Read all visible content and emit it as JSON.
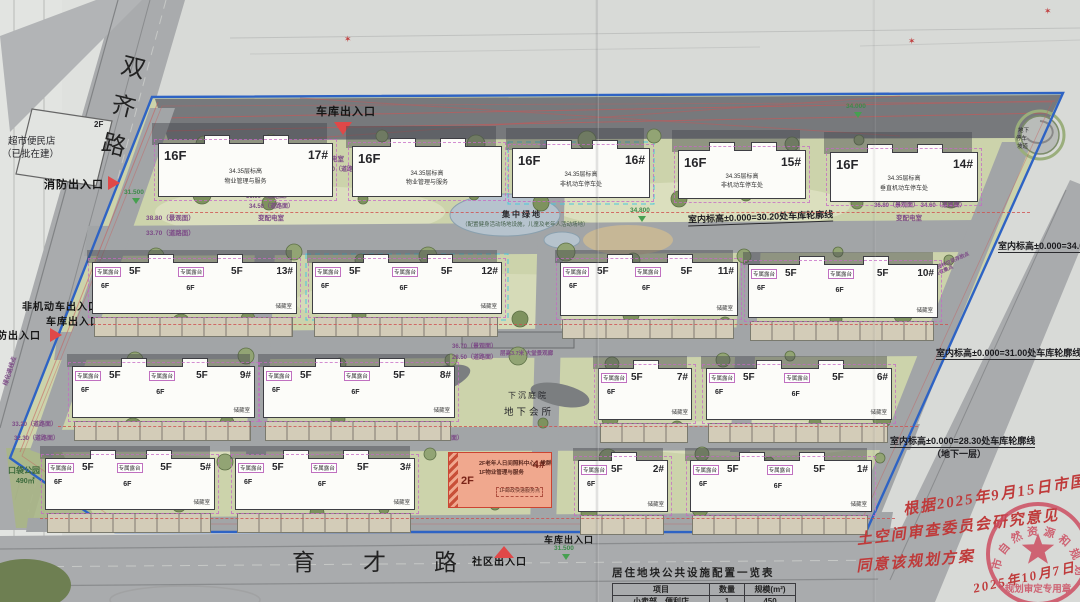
{
  "roads": {
    "left_vertical": "双齐路",
    "bottom": "育才路"
  },
  "northwest_parcel": {
    "floor": "2F",
    "name": "超市便民店",
    "status": "（已批在建）"
  },
  "entrances": [
    {
      "label": "消防出入口",
      "x": 44,
      "y": 179,
      "fs": 11,
      "marker": "right",
      "mx": 108,
      "my": 176
    },
    {
      "label": "车库出入口",
      "x": 316,
      "y": 106,
      "fs": 11,
      "marker": "down",
      "mx": 334,
      "my": 122
    },
    {
      "label": "非机动车出入口",
      "x": 22,
      "y": 302,
      "fs": 10,
      "marker": "",
      "mx": 0,
      "my": 0
    },
    {
      "label": "车库出入口",
      "x": 46,
      "y": 317,
      "fs": 10,
      "marker": "right",
      "mx": 50,
      "my": 328
    },
    {
      "label": "消防出入口",
      "x": -14,
      "y": 331,
      "fs": 10,
      "marker": "",
      "mx": 0,
      "my": 0
    },
    {
      "label": "车库出入口",
      "x": 544,
      "y": 535,
      "fs": 9,
      "marker": "",
      "mx": 0,
      "my": 0
    },
    {
      "label": "社区出入口",
      "x": 472,
      "y": 557,
      "fs": 10,
      "marker": "up",
      "mx": 494,
      "my": 546
    }
  ],
  "annotations": [
    {
      "t": "室内标高±0.000=30.20处车库轮廓线",
      "x": 688,
      "y": 212,
      "rot": -2,
      "nou": false
    },
    {
      "t": "室内标高±0.000=34.00处车库轮廓线",
      "x": 998,
      "y": 241,
      "rot": 0,
      "nou": false
    },
    {
      "t": "室内标高±0.000=31.00处车库轮廓线",
      "x": 936,
      "y": 348,
      "rot": 0,
      "nou": false
    },
    {
      "t": "室内标高±0.000=28.30处车库轮廓线",
      "x": 890,
      "y": 436,
      "rot": 0,
      "nou": false
    },
    {
      "t": "（地下一层）",
      "x": 932,
      "y": 449,
      "rot": 0,
      "nou": true
    }
  ],
  "spot_levels": [
    {
      "t": "38.80（景观面）",
      "x": 146,
      "y": 215,
      "fs": 6.5
    },
    {
      "t": "33.70（道路面）",
      "x": 146,
      "y": 230,
      "fs": 6.5
    },
    {
      "t": "36.90（道路面）",
      "x": 246,
      "y": 194,
      "fs": 6
    },
    {
      "t": "34.50（道路面）",
      "x": 249,
      "y": 204,
      "fs": 6
    },
    {
      "t": "变配电室",
      "x": 258,
      "y": 215,
      "fs": 6.5
    },
    {
      "t": "变配电室",
      "x": 318,
      "y": 156,
      "fs": 6.5
    },
    {
      "t": "34.50（道路面）",
      "x": 320,
      "y": 167,
      "fs": 6
    },
    {
      "t": "36.80（景观面） 34.60（道路面）",
      "x": 874,
      "y": 203,
      "fs": 6
    },
    {
      "t": "变配电室",
      "x": 896,
      "y": 215,
      "fs": 6.5
    },
    {
      "t": "36.70（景观面）",
      "x": 452,
      "y": 344,
      "fs": 6
    },
    {
      "t": "28.50（道路面）",
      "x": 452,
      "y": 355,
      "fs": 6
    },
    {
      "t": "28.50（道路面）",
      "x": 418,
      "y": 436,
      "fs": 6
    },
    {
      "t": "33.20（道路面）",
      "x": 12,
      "y": 422,
      "fs": 6
    },
    {
      "t": "32.30（道路面）",
      "x": 14,
      "y": 436,
      "fs": 6
    },
    {
      "t": "层高3.7米 大堂景观廊",
      "x": 500,
      "y": 351,
      "fs": 5.5
    },
    {
      "t": "大件垃圾、园林垃圾存放点",
      "x": 912,
      "y": 264,
      "fs": 5,
      "rot": -24
    },
    {
      "t": "生活垃圾收集点",
      "x": 920,
      "y": 272,
      "fs": 5,
      "rot": -24
    },
    {
      "t": "绿化退线点",
      "x": -4,
      "y": 368,
      "fs": 6,
      "rot": -72
    },
    {
      "t": "口袋公园",
      "x": 8,
      "y": 466,
      "fs": 8,
      "c": "#3c6a3c"
    },
    {
      "t": "490㎡",
      "x": 16,
      "y": 478,
      "fs": 7,
      "c": "#3c6a3c"
    }
  ],
  "elevation_markers": [
    {
      "t": "34.000",
      "x": 846,
      "y": 103
    },
    {
      "t": "34.800",
      "x": 630,
      "y": 207
    },
    {
      "t": "31.500",
      "x": 124,
      "y": 189
    },
    {
      "t": "33.500",
      "x": 412,
      "y": 285
    },
    {
      "t": "31.500",
      "x": 554,
      "y": 545
    }
  ],
  "red_marks": [
    {
      "x": 344,
      "y": 34
    },
    {
      "x": 908,
      "y": 36
    },
    {
      "x": 1044,
      "y": 6
    }
  ],
  "green_space": {
    "label": "集中绿地",
    "subtext": "（配置健身活动场地设施，儿童及老年人活动场地）"
  },
  "sunken": {
    "courtyard": "下沉庭院",
    "club": "地下会所"
  },
  "ramp_labels": {
    "l1": "地下",
    "l2": "停车",
    "l3": "坡道"
  },
  "building_tags": {
    "terrace": "专属露台",
    "f6": "6F",
    "storage": "储藏室"
  },
  "buildings": [
    {
      "kind": "tall",
      "x": 158,
      "y": 143,
      "w": 175,
      "h": 54,
      "floor": "16F",
      "num": "17#",
      "note1": "34.35层标高",
      "note2": "物业管理与服务"
    },
    {
      "kind": "tall",
      "x": 352,
      "y": 146,
      "w": 150,
      "h": 51,
      "floor": "16F",
      "num": "",
      "note1": "34.35层标高",
      "note2": "物业管理与服务"
    },
    {
      "kind": "tall",
      "x": 512,
      "y": 148,
      "w": 138,
      "h": 50,
      "floor": "16F",
      "num": "16#",
      "note1": "34.35层标高",
      "note2": "非机动车停车处"
    },
    {
      "kind": "tall",
      "x": 678,
      "y": 150,
      "w": 128,
      "h": 49,
      "floor": "16F",
      "num": "15#",
      "note1": "34.35层标高",
      "note2": "非机动车停车处"
    },
    {
      "kind": "tall",
      "x": 830,
      "y": 152,
      "w": 148,
      "h": 50,
      "floor": "16F",
      "num": "14#",
      "note1": "34.35层标高",
      "note2": "垂直机动车停车处"
    },
    {
      "kind": "low",
      "x": 92,
      "y": 262,
      "w": 205,
      "h": 52,
      "floor": "5F",
      "num": "13#"
    },
    {
      "kind": "low",
      "x": 312,
      "y": 262,
      "w": 190,
      "h": 52,
      "floor": "5F",
      "num": "12#"
    },
    {
      "kind": "low",
      "x": 560,
      "y": 262,
      "w": 178,
      "h": 54,
      "floor": "5F",
      "num": "11#"
    },
    {
      "kind": "low",
      "x": 748,
      "y": 264,
      "w": 190,
      "h": 54,
      "floor": "5F",
      "num": "10#"
    },
    {
      "kind": "low",
      "x": 72,
      "y": 366,
      "w": 183,
      "h": 52,
      "floor": "5F",
      "num": "9#"
    },
    {
      "kind": "low",
      "x": 263,
      "y": 366,
      "w": 192,
      "h": 52,
      "floor": "5F",
      "num": "8#"
    },
    {
      "kind": "lowhalf",
      "x": 598,
      "y": 368,
      "w": 94,
      "h": 52,
      "floor": "5F",
      "num": "7#"
    },
    {
      "kind": "low",
      "x": 706,
      "y": 368,
      "w": 186,
      "h": 52,
      "floor": "5F",
      "num": "6#"
    },
    {
      "kind": "low",
      "x": 45,
      "y": 458,
      "w": 170,
      "h": 52,
      "floor": "5F",
      "num": "5#"
    },
    {
      "kind": "low",
      "x": 235,
      "y": 458,
      "w": 180,
      "h": 52,
      "floor": "5F",
      "num": "3#"
    },
    {
      "kind": "lowhalf",
      "x": 578,
      "y": 460,
      "w": 90,
      "h": 52,
      "floor": "5F",
      "num": "2#"
    },
    {
      "kind": "low",
      "x": 690,
      "y": 460,
      "w": 182,
      "h": 52,
      "floor": "5F",
      "num": "1#"
    }
  ],
  "community_building": {
    "floor": "2F",
    "num": "4#",
    "line1": "2F老年人日间照料中心、党群",
    "line2": "1F物业管理与服务",
    "line3": "1F邮政快递服务点"
  },
  "table": {
    "title": "居住地块公共设施配置一览表",
    "columns": [
      "项目",
      "数量",
      "规模(m²)"
    ],
    "rows": [
      [
        "小卖部、便利店",
        "1",
        "450"
      ]
    ]
  },
  "handwriting": {
    "line1": "根据2025年9月15日市国",
    "line2": "土空间审查委员会研究意见",
    "line3": "同意该规划方案",
    "date": "2025年10月7日"
  },
  "stamp": {
    "arc_text": "市自然资源和规划局",
    "banner": "规划审定专用章"
  },
  "colors": {
    "boundary": "#2e63c4",
    "entrance_marker": "#e04848",
    "handwriting": "#bf3a3a",
    "stamp": "#cc4a5e",
    "community_fill": "#f0a88e",
    "site_green": "#ccd3ab",
    "road_gray": "#a6a9ab"
  }
}
